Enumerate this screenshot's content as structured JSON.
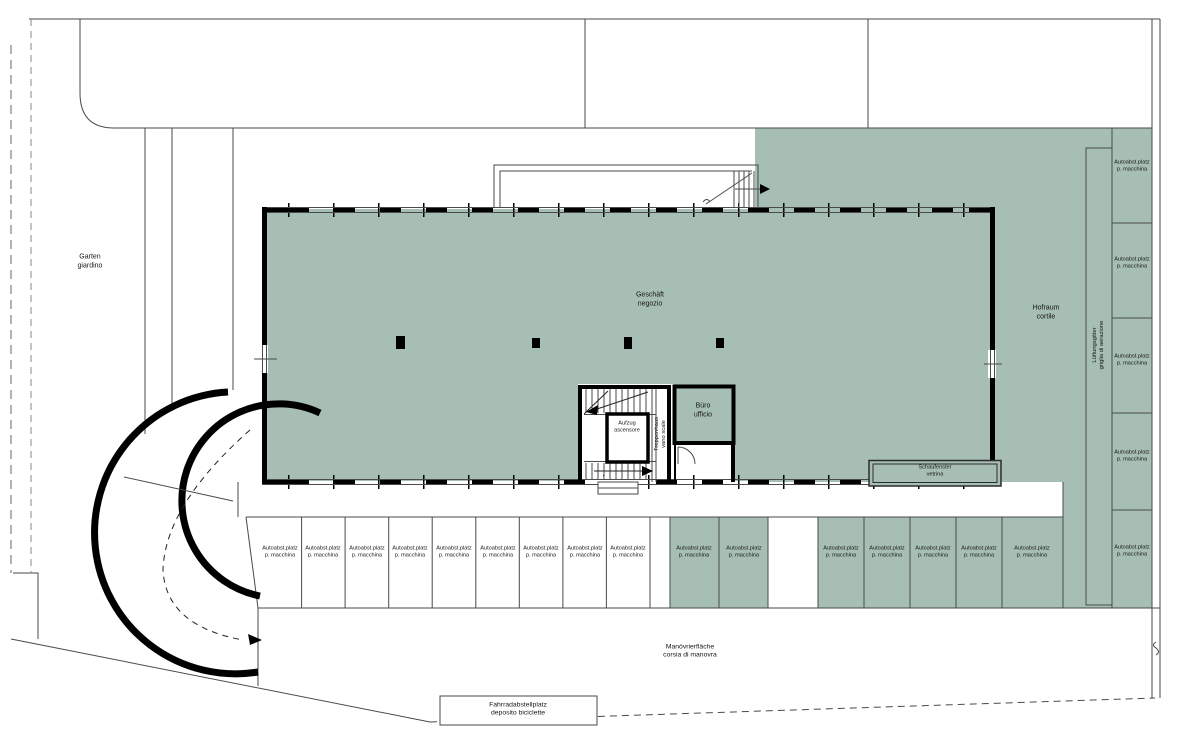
{
  "plan": {
    "labels": {
      "garden_l1": "Garten",
      "garden_l2": "giardino",
      "shop_l1": "Geschäft",
      "shop_l2": "negozio",
      "courtyard_l1": "Hofraum",
      "courtyard_l2": "cortile",
      "vent_l1": "Lüftungsgitter",
      "vent_l2": "griglia di aerazione",
      "stairwell_l1": "Treppenhaus",
      "stairwell_l2": "vano scale",
      "elevator_l1": "Aufzug",
      "elevator_l2": "ascensore",
      "office_l1": "Büro",
      "office_l2": "ufficio",
      "display_window_l1": "Schaufenster",
      "display_window_l2": "vetrina",
      "maneuver_l1": "Manövrierfläche",
      "maneuver_l2": "corsia di manovra",
      "bike_l1": "Fahrradabstellplatz",
      "bike_l2": "deposito biciclette",
      "stall_l1": "Autoabst.platz",
      "stall_l2": "p. macchina"
    },
    "colors": {
      "zone_green": "#a6beb3"
    },
    "parking": {
      "bottom_white_stalls": 9,
      "bottom_green_stalls_left": 2,
      "bottom_green_stalls_right": 5,
      "right_column_stalls": 5
    }
  }
}
